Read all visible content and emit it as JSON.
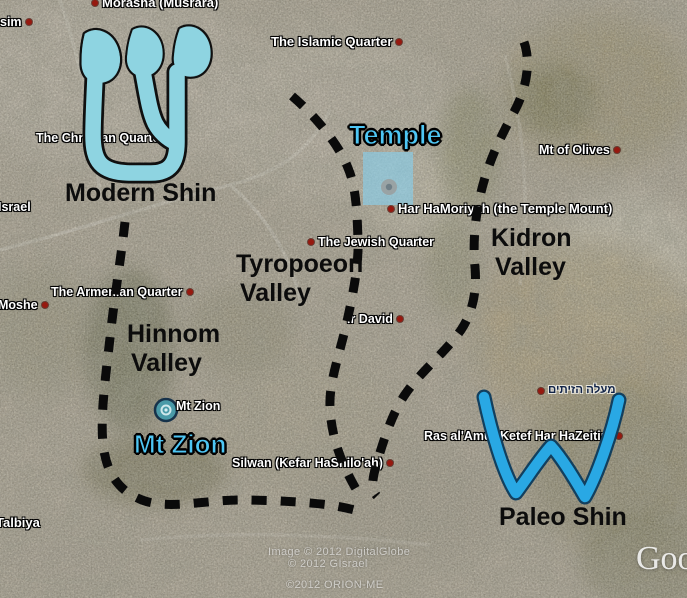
{
  "placemarks": [
    {
      "text": "Morasha (Musrara)"
    },
    {
      "text": "sim"
    },
    {
      "text": "The Islamic Quarter"
    },
    {
      "text": "The Christian Quarter"
    },
    {
      "text": "Mt of Olives"
    },
    {
      "text": "Har HaMoriyah (the Temple Mount)"
    },
    {
      "text": "The Jewish Quarter"
    },
    {
      "text": "The Armenian Quarter"
    },
    {
      "text": "Israel"
    },
    {
      "text": "Moshe"
    },
    {
      "text": "Ir David"
    },
    {
      "text": "Mt Zion"
    },
    {
      "text": "Silwan (Kefar HaShilo'ah)"
    },
    {
      "text": "Ras al'Amud"
    },
    {
      "text": "Ketef Har HaZeitim"
    },
    {
      "text": "מעלה הזיתים"
    },
    {
      "text": "Talbiya"
    }
  ],
  "annotations": {
    "modern_shin": "Modern Shin",
    "paleo_shin": "Paleo Shin",
    "temple": "Temple",
    "mt_zion": "Mt Zion",
    "tyropoeon": {
      "line1": "Tyropoeon",
      "line2": "Valley"
    },
    "hinnom": {
      "line1": "Hinnom",
      "line2": "Valley"
    },
    "kidron": {
      "line1": "Kidron",
      "line2": "Valley"
    }
  },
  "credits": {
    "line1": "Image © 2012 DigitalGlobe",
    "line2": "© 2012 GIsrael",
    "line3": "©2012 ORION-ME",
    "logo": "Google"
  },
  "icons": {
    "mt_zion_marker": "photo-placemark-circle",
    "placemark_dot": "red-dot"
  },
  "colors": {
    "modern_shin_fill": "#8ed4e1",
    "paleo_shin_stroke": "#29a8e4",
    "blue_label": "#4ec6f4",
    "dashed_line": "#0a0a0a",
    "placemark_dot": "#96190f",
    "temple_overlay": "rgba(137,205,232,0.66)"
  }
}
